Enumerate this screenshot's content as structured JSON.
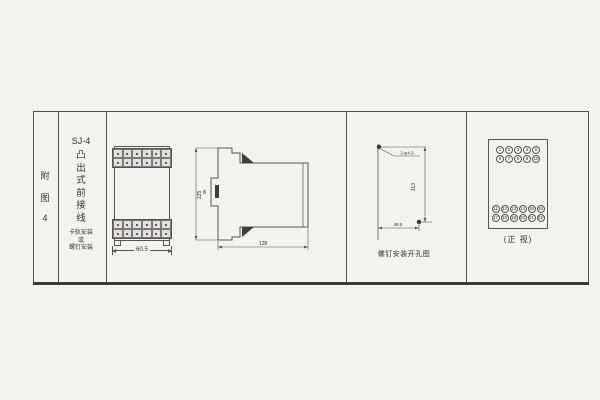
{
  "palette": {
    "background": "#f2f2f0",
    "line": "#555555",
    "text": "#333333"
  },
  "index_column": {
    "chars": [
      "附",
      "图",
      "4"
    ]
  },
  "title_column": {
    "model": "SJ-4",
    "title_chars": [
      "凸",
      "出",
      "式",
      "前",
      "接",
      "线"
    ],
    "subtitle_lines": [
      "卡轨安装",
      "或",
      "螺钉安装"
    ]
  },
  "front_view": {
    "cells_per_block": 12,
    "width_dim": "60.5"
  },
  "side_view": {
    "height_dim": "125",
    "notch_dim": "35",
    "depth_dim": "128"
  },
  "drill_view": {
    "holes_label": "2-φ4.5",
    "vertical_dim": "113",
    "horizontal_dim": "48.5",
    "caption": "螺钉安装开孔图"
  },
  "terminal_panel": {
    "caption": "(正 视)",
    "top_rows": [
      [
        "1",
        "2",
        "3",
        "4",
        "5"
      ],
      [
        "6",
        "7",
        "8",
        "9",
        "10"
      ]
    ],
    "bottom_rows": [
      [
        "11",
        "12",
        "13",
        "14",
        "15",
        "16"
      ],
      [
        "17",
        "18",
        "19",
        "20",
        "21",
        "22"
      ]
    ]
  }
}
